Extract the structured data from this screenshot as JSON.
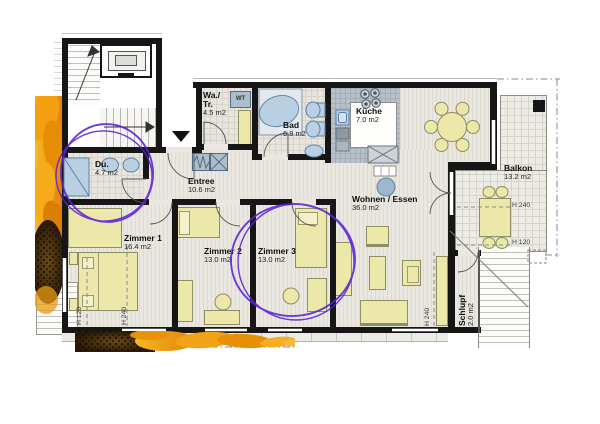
{
  "title": "apartment-floor-plan",
  "colors": {
    "wall": "#161616",
    "furniture": "#ebe8a9",
    "fixture": "#b9cfe2",
    "kitchen_floor": "#b6c0c9",
    "annotation_circle": "#5b21d6",
    "sunflower_orange": "#ec9410",
    "sunflower_seeds": "#2c1a06"
  },
  "rooms": [
    {
      "name": "Du.",
      "area": "4.7 m2"
    },
    {
      "name": "Wa./",
      "name_line2": "Tr.",
      "area": "4.5 m2"
    },
    {
      "name": "Bad",
      "area": "6.8 m2"
    },
    {
      "name": "Küche",
      "area": "7.0 m2"
    },
    {
      "name": "Entree",
      "area": "10.6 m2"
    },
    {
      "name": "Wohnen / Essen",
      "area": "36.0 m2"
    },
    {
      "name": "Zimmer 1",
      "area": "16.4 m2"
    },
    {
      "name": "Zimmer 2",
      "area": "13.0 m2"
    },
    {
      "name": "Zimmer 3",
      "area": "13.0 m2"
    },
    {
      "name": "Balkon",
      "area": "13.2 m2"
    },
    {
      "name": "Schlupf",
      "area": "2.0 m2"
    }
  ],
  "height_labels": {
    "h240": "H 240",
    "h120": "H 120"
  },
  "appliances": {
    "washer_dryer": "WT"
  },
  "annotations": {
    "circle_count": 2
  }
}
